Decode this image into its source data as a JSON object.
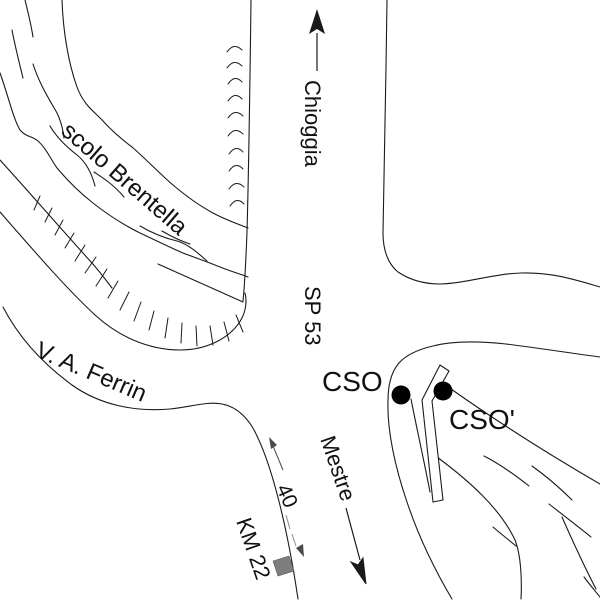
{
  "map": {
    "labels": {
      "canal": "scolo Brentella",
      "street": "V. A. Ferrin",
      "destination_north": "Chioggia",
      "route": "SP 53",
      "cso": "CSO",
      "cso_prime": "CSO'",
      "destination_south": "Mestre",
      "km_marker": "KM 22",
      "distance": "40"
    },
    "colors": {
      "line": "#1a1a1a",
      "faded_text": "#ababab",
      "km_square": "#7d7d7d",
      "dot": "#000000",
      "background": "#ffffff"
    }
  }
}
